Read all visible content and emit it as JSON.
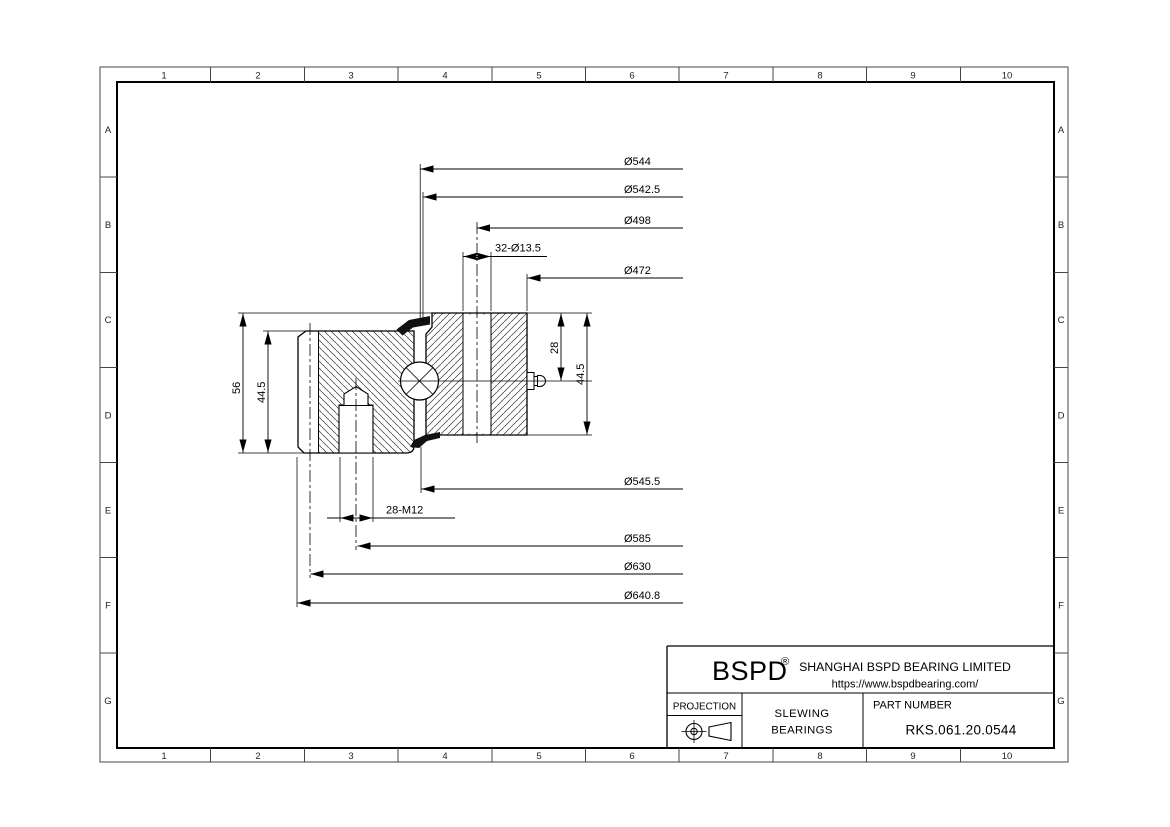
{
  "sheet": {
    "grid_columns": [
      "1",
      "2",
      "3",
      "4",
      "5",
      "6",
      "7",
      "8",
      "9",
      "10"
    ],
    "grid_rows": [
      "A",
      "B",
      "C",
      "D",
      "E",
      "F",
      "G"
    ]
  },
  "dimensions": {
    "top": [
      "Ø544",
      "Ø542.5",
      "Ø498",
      "32-Ø13.5",
      "Ø472"
    ],
    "bottom": [
      "Ø545.5",
      "28-M12",
      "Ø585",
      "Ø630",
      "Ø640.8"
    ],
    "left": [
      "56",
      "44.5"
    ],
    "right": [
      "28",
      "44.5"
    ]
  },
  "title_block": {
    "brand": "BSPD",
    "registered_mark": "®",
    "company": "SHANGHAI BSPD BEARING LIMITED",
    "website": "https://www.bspdbearing.com/",
    "projection_label": "PROJECTION",
    "product_lines": [
      "SLEWING",
      "BEARINGS"
    ],
    "part_number_label": "PART  NUMBER",
    "part_number": "RKS.061.20.0544"
  }
}
